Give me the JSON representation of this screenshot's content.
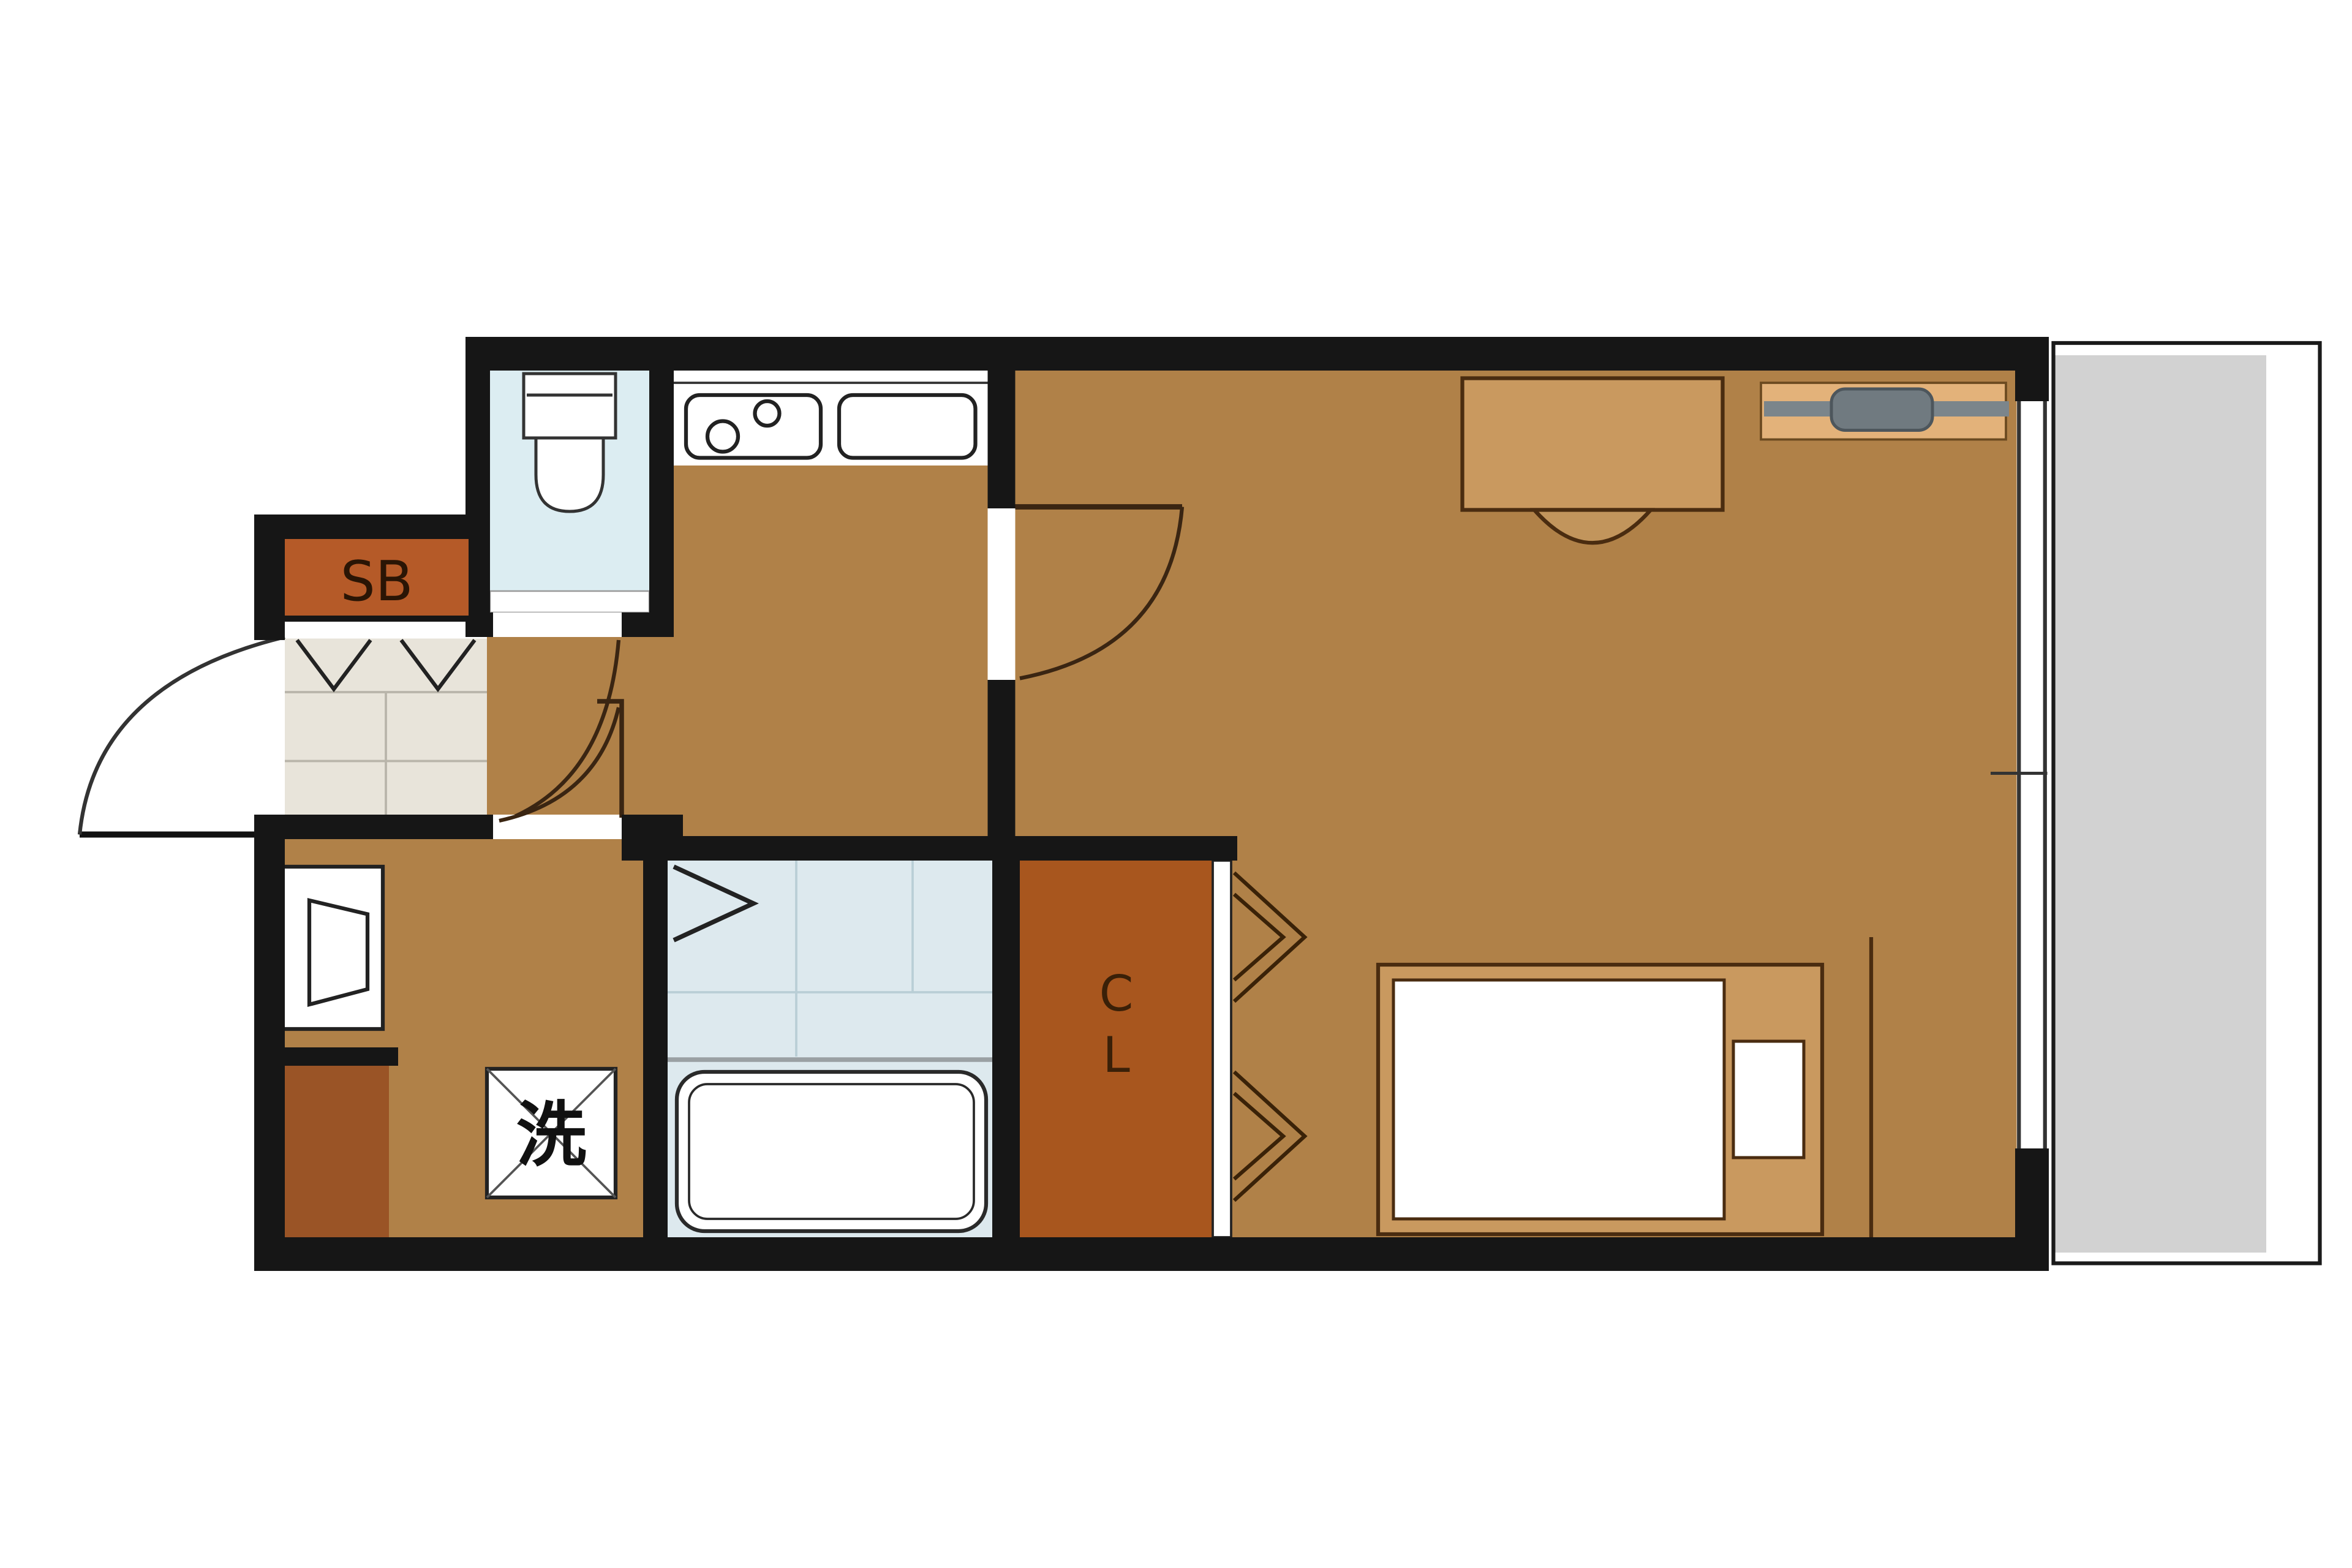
{
  "plan": {
    "type": "apartment-floor-plan",
    "labels": {
      "shoe_box": "SB",
      "laundry": "洗",
      "closet": "CL",
      "closet_line1": "C",
      "closet_line2": "L"
    },
    "palette": {
      "wall": "#161616",
      "floor_wood": "#b08148",
      "closet_fill": "#a8561e",
      "shoe_box_fill": "#b55a28",
      "counter_dark": "#9a5426",
      "entry_tile": "#e8e4da",
      "toilet_floor": "#dcedf2",
      "bath_floor": "#dde9ee",
      "balcony": "#d2d2d2",
      "furniture_tan": "#c9995f",
      "tv_board": "#e3b27a",
      "tv_gray": "#7b858b",
      "fixture_white": "#ffffff",
      "label_dark": "#2a1505"
    }
  }
}
